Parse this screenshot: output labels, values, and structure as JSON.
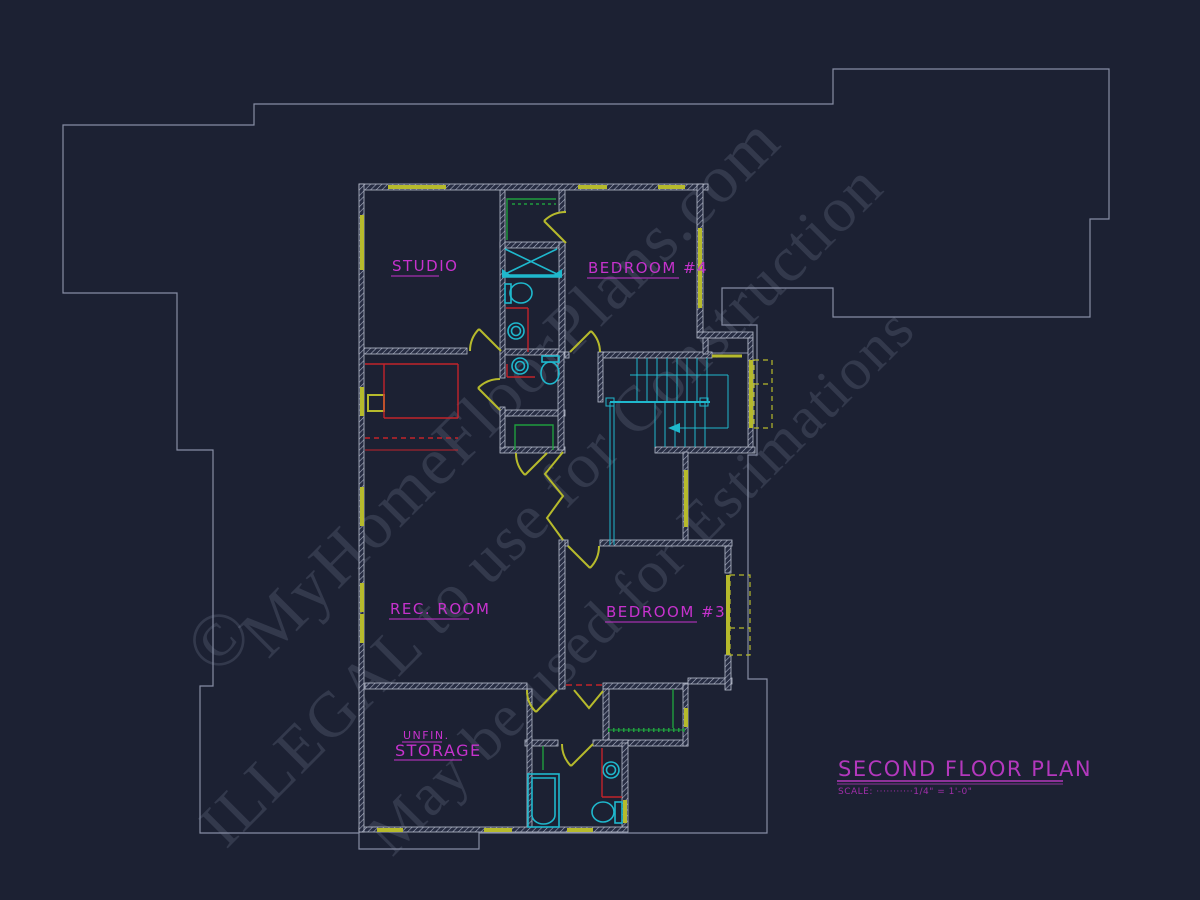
{
  "drawing": {
    "rooms": {
      "studio": "STUDIO",
      "bedroom4": "BEDROOM #4",
      "rec_room": "REC. ROOM",
      "bedroom3": "BEDROOM #3",
      "storage_line1": "UNFIN.",
      "storage_line2": "STORAGE"
    },
    "title_block": {
      "title": "SECOND FLOOR PLAN",
      "scale": "SCALE: ···········1/4\" = 1'-0\""
    },
    "watermark": {
      "copyright": "©",
      "line1": "MyHomeFloorPlans.com",
      "line2": "ILLEGAL to use for Construction",
      "line3": "May be used for Estimations"
    },
    "colors": {
      "background": "#1c2133",
      "roof_outline": "#868da4",
      "walls": "#b9bfce",
      "windows_doors": "#b6ba2c",
      "plumbing_fixtures": "#1fb8cd",
      "shelving": "#1f9e3e",
      "cabinetry": "#c2242b",
      "labels": "#c632cd",
      "title": "#b338bd"
    }
  }
}
